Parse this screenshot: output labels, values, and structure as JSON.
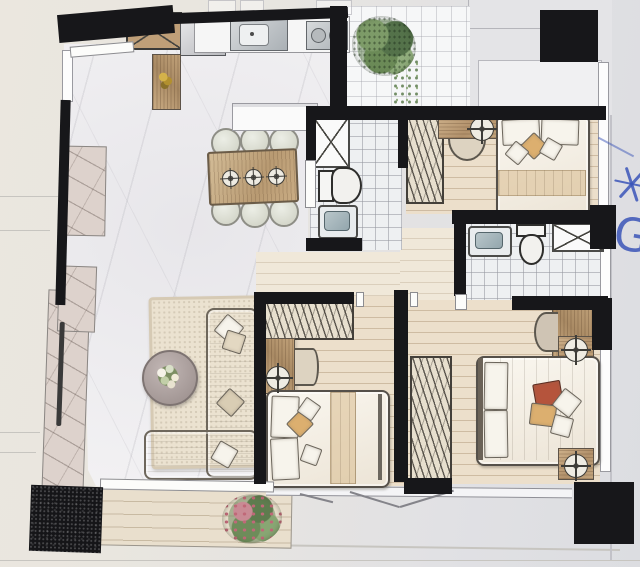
{
  "scene": {
    "type": "floor-plan-photo",
    "description": "Photograph of a hand-rendered residential floor plan on paper: open kitchen and dining with marble floor, living room with L-sofa, three bedrooms with wardrobes, two bathrooms, utility balcony with plant, living balcony with flowering plant, blue pen marks in right margin"
  },
  "annotations": {
    "letter_mark": "G",
    "star_mark": "hand-drawn-asterisk",
    "pen_color": "#3b55b8"
  },
  "palette": {
    "paper_left": "#ebe7df",
    "paper_right": "#dcdde1",
    "wall": "#17171a",
    "marble": "#f3f2f4",
    "tile": "#eef0f2",
    "wood_floor": "#ecdfcb",
    "wood_furniture": "#bf9f78",
    "fabric": "#f7f4ec",
    "rug": "#ebe2d0",
    "plant_green": "#5e7c4e",
    "plant_pink": "#c06878",
    "accent_tan": "#dcaf6f",
    "accent_rust": "#b5543c",
    "granite": "#151518",
    "pen": "#3b55b8"
  },
  "rooms": [
    {
      "name": "kitchen"
    },
    {
      "name": "dining"
    },
    {
      "name": "living"
    },
    {
      "name": "utility-balcony"
    },
    {
      "name": "bedroom-1"
    },
    {
      "name": "bathroom-1"
    },
    {
      "name": "bathroom-2"
    },
    {
      "name": "bedroom-2"
    },
    {
      "name": "master-bedroom"
    },
    {
      "name": "living-balcony"
    }
  ],
  "fixtures": {
    "kitchen": [
      "crossed-cabinet",
      "tall-gray-cabinet",
      "sink",
      "two-burner-stove",
      "counter",
      "entry-console",
      "sideboard"
    ],
    "dining": [
      "wood-table",
      "six-round-chairs",
      "three-place-settings"
    ],
    "living": [
      "textured-rug",
      "l-shaped-sofa",
      "round-coffee-table",
      "flower-bouquet",
      "tv-panel",
      "two-marble-benches"
    ],
    "bedroom_1": [
      "double-bed",
      "hatched-wardrobe",
      "desk",
      "lamp",
      "half-round-chair"
    ],
    "bedroom_2": [
      "double-bed",
      "hatched-wardrobe",
      "dresser",
      "lamp",
      "half-round-chair"
    ],
    "master_bedroom": [
      "double-bed",
      "hatched-wardrobe",
      "dresser",
      "round-mirror",
      "two-lamps"
    ],
    "bathroom_1": [
      "shower-box",
      "toilet",
      "sink"
    ],
    "bathroom_2": [
      "sink",
      "toilet",
      "shower-box"
    ],
    "plants": [
      "green-shrub",
      "trailing-vine",
      "pink-flowering-shrub",
      "gold-console-decor"
    ]
  }
}
